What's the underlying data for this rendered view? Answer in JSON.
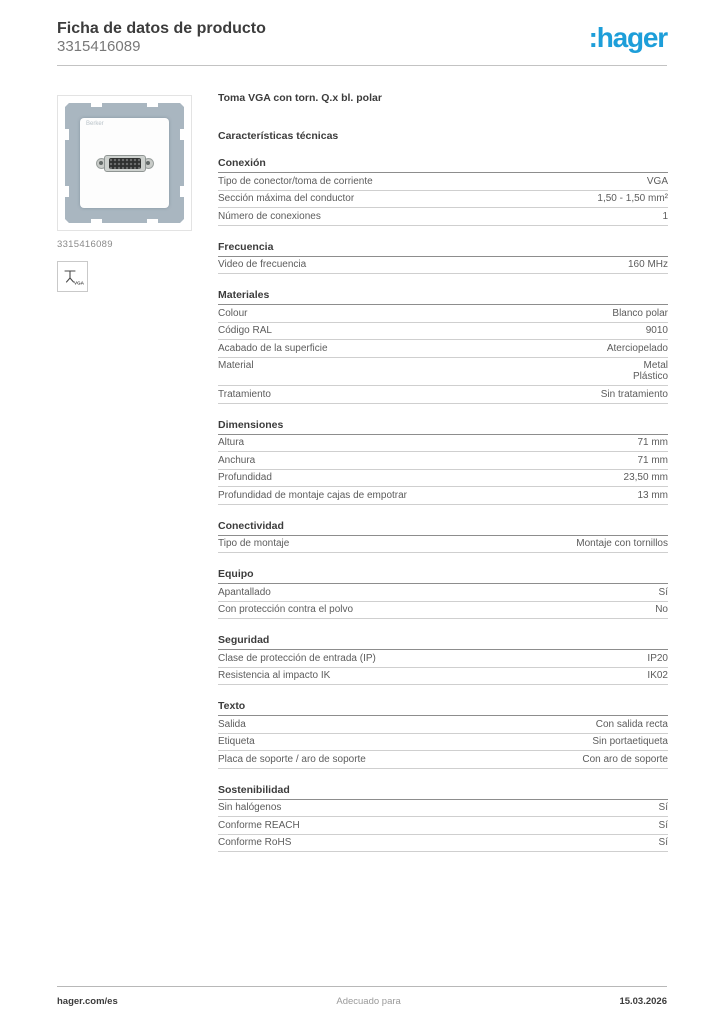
{
  "header": {
    "title": "Ficha de datos de producto",
    "reference": "3315416089",
    "logo": ":hager"
  },
  "colors": {
    "brand_blue": "#1d9ed9",
    "frame_gray": "#a9b6c0"
  },
  "product": {
    "name": "Toma VGA con torn. Q.x bl. polar",
    "image_caption": "3315416089",
    "plate_mark": "Berker",
    "vga_icon_label": "VGA"
  },
  "specs": {
    "heading": "Características técnicas",
    "sections": [
      {
        "title": "Conexión",
        "rows": [
          {
            "label": "Tipo de conector/toma de corriente",
            "value": "VGA"
          },
          {
            "label": "Sección máxima del conductor",
            "value": "1,50 - 1,50 mm²"
          },
          {
            "label": "Número de conexiones",
            "value": "1"
          }
        ]
      },
      {
        "title": "Frecuencia",
        "rows": [
          {
            "label": "Video de frecuencia",
            "value": "160 MHz"
          }
        ]
      },
      {
        "title": "Materiales",
        "rows": [
          {
            "label": "Colour",
            "value": "Blanco polar"
          },
          {
            "label": "Código RAL",
            "value": "9010"
          },
          {
            "label": "Acabado de la superficie",
            "value": "Aterciopelado"
          },
          {
            "label": "Material",
            "value": "Metal\nPlástico"
          },
          {
            "label": "Tratamiento",
            "value": "Sin tratamiento"
          }
        ]
      },
      {
        "title": "Dimensiones",
        "rows": [
          {
            "label": "Altura",
            "value": "71 mm"
          },
          {
            "label": "Anchura",
            "value": "71 mm"
          },
          {
            "label": "Profundidad",
            "value": "23,50 mm"
          },
          {
            "label": "Profundidad de montaje cajas de empotrar",
            "value": "13 mm"
          }
        ]
      },
      {
        "title": "Conectividad",
        "rows": [
          {
            "label": "Tipo de montaje",
            "value": "Montaje con tornillos"
          }
        ]
      },
      {
        "title": "Equipo",
        "rows": [
          {
            "label": "Apantallado",
            "value": "Sí"
          },
          {
            "label": "Con protección contra el polvo",
            "value": "No"
          }
        ]
      },
      {
        "title": "Seguridad",
        "rows": [
          {
            "label": "Clase de protección de entrada (IP)",
            "value": "IP20"
          },
          {
            "label": "Resistencia al impacto IK",
            "value": "IK02"
          }
        ]
      },
      {
        "title": "Texto",
        "rows": [
          {
            "label": "Salida",
            "value": "Con salida recta"
          },
          {
            "label": "Etiqueta",
            "value": "Sin portaetiqueta"
          },
          {
            "label": "Placa de soporte / aro de soporte",
            "value": "Con aro de soporte"
          }
        ]
      },
      {
        "title": "Sostenibilidad",
        "rows": [
          {
            "label": "Sin halógenos",
            "value": "Sí"
          },
          {
            "label": "Conforme REACH",
            "value": "Sí"
          },
          {
            "label": "Conforme RoHS",
            "value": "Sí"
          }
        ]
      }
    ]
  },
  "footer": {
    "website": "hager.com/es",
    "center_text": "Adecuado para",
    "date": "15.03.2026"
  }
}
